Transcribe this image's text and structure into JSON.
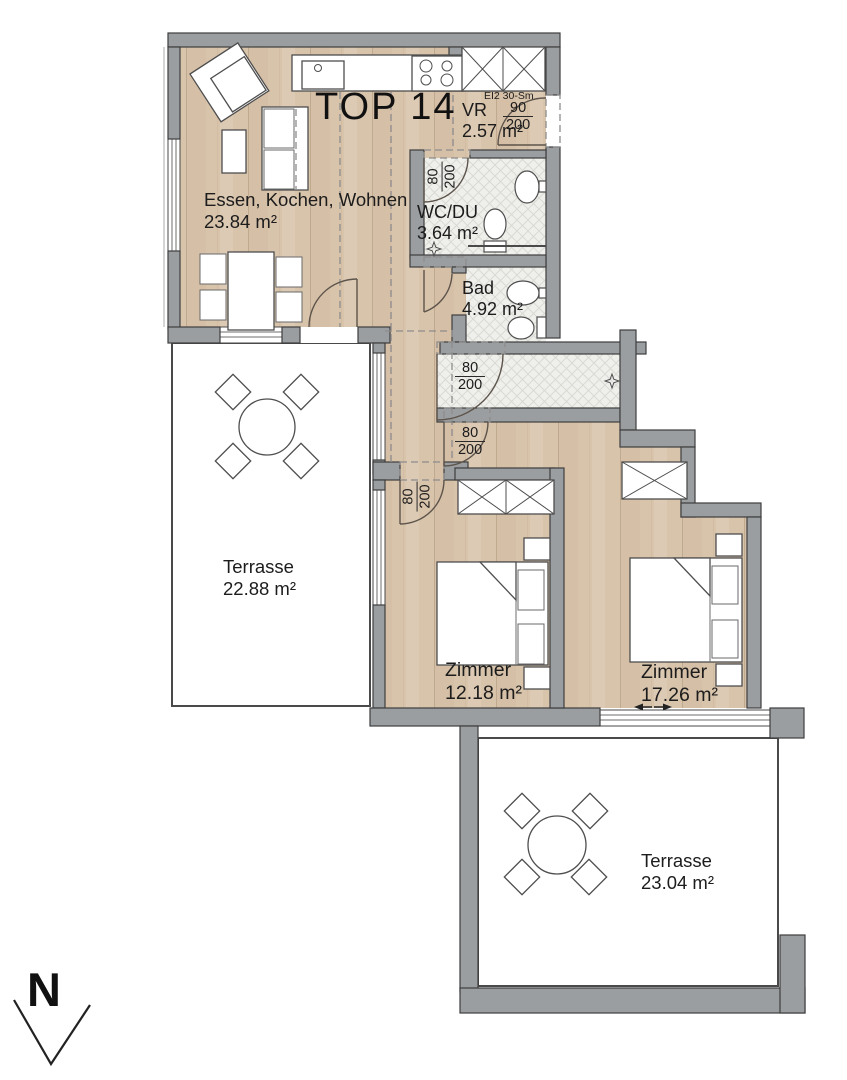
{
  "plan": {
    "title": "TOP 14",
    "north_label": "N",
    "rooms": {
      "living": {
        "name": "Essen, Kochen, Wohnen",
        "area": "23.84 m²"
      },
      "vestibule": {
        "name": "VR",
        "area": "2.57 m²"
      },
      "shower_wc": {
        "name": "WC/DU",
        "area": "3.64 m²"
      },
      "bath": {
        "name": "Bad",
        "area": "4.92 m²"
      },
      "terrace_west": {
        "name": "Terrasse",
        "area": "22.88 m²"
      },
      "bedroom_small": {
        "name": "Zimmer",
        "area": "12.18 m²"
      },
      "bedroom_large": {
        "name": "Zimmer",
        "area": "17.26 m²"
      },
      "terrace_south": {
        "name": "Terrasse",
        "area": "23.04 m²"
      }
    },
    "entry_door": {
      "fire_rating": "EI2 30-Sm",
      "width_cm": "90",
      "height_cm": "200"
    },
    "interior_door": {
      "width_cm": "80",
      "height_cm": "200"
    },
    "colors": {
      "wall": "#9b9ea0",
      "wood_floor": "#d8c3ab",
      "terrace_floor": "#e8ddcd",
      "tile_floor": "#efefec"
    }
  }
}
